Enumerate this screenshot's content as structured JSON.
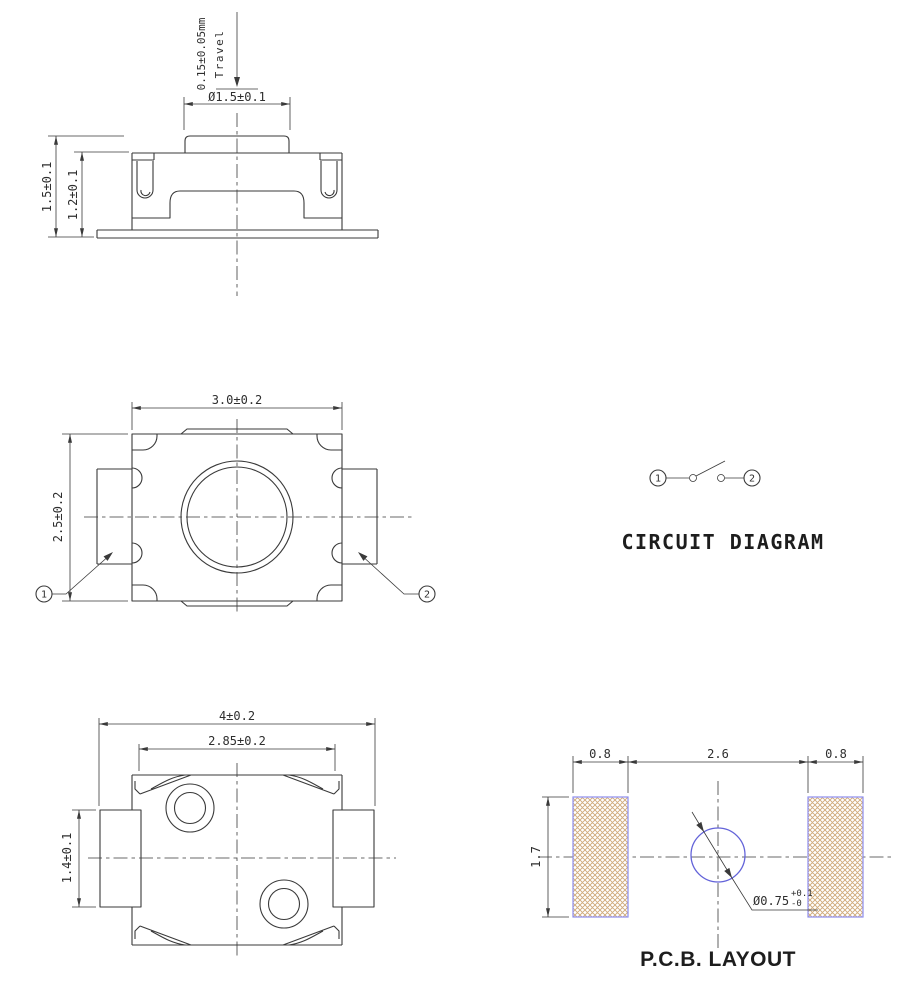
{
  "meta": {
    "drawing_type": "SMD tact switch engineering drawing",
    "colors": {
      "line": "#3a3a3a",
      "pad_border": "#8d8dee",
      "pad_hatch": "#cfa878",
      "hole_stroke": "#6363d9"
    }
  },
  "side_view": {
    "travel_value": "0.15±0.05mm",
    "travel_word": "Travel",
    "actuator_diameter": "Ø1.5±0.1",
    "overall_height": "1.5±0.1",
    "body_height": "1.2±0.1"
  },
  "top_view": {
    "body_width": "3.0±0.2",
    "body_depth": "2.5±0.2",
    "terminal_1": "1",
    "terminal_2": "2"
  },
  "circuit_diagram": {
    "title": "CIRCUIT DIAGRAM",
    "terminal_1": "1",
    "terminal_2": "2"
  },
  "bottom_view": {
    "overall_width": "4±0.2",
    "base_width": "2.85±0.2",
    "terminal_width": "1.4±0.1"
  },
  "pcb_layout": {
    "title": "P.C.B. LAYOUT",
    "left_pad_width": "0.8",
    "pad_gap": "2.6",
    "right_pad_width": "0.8",
    "pad_height": "1.7",
    "hole_diameter": "Ø0.75",
    "hole_tolerance_upper": "+0.1",
    "hole_tolerance_lower": "-0"
  }
}
